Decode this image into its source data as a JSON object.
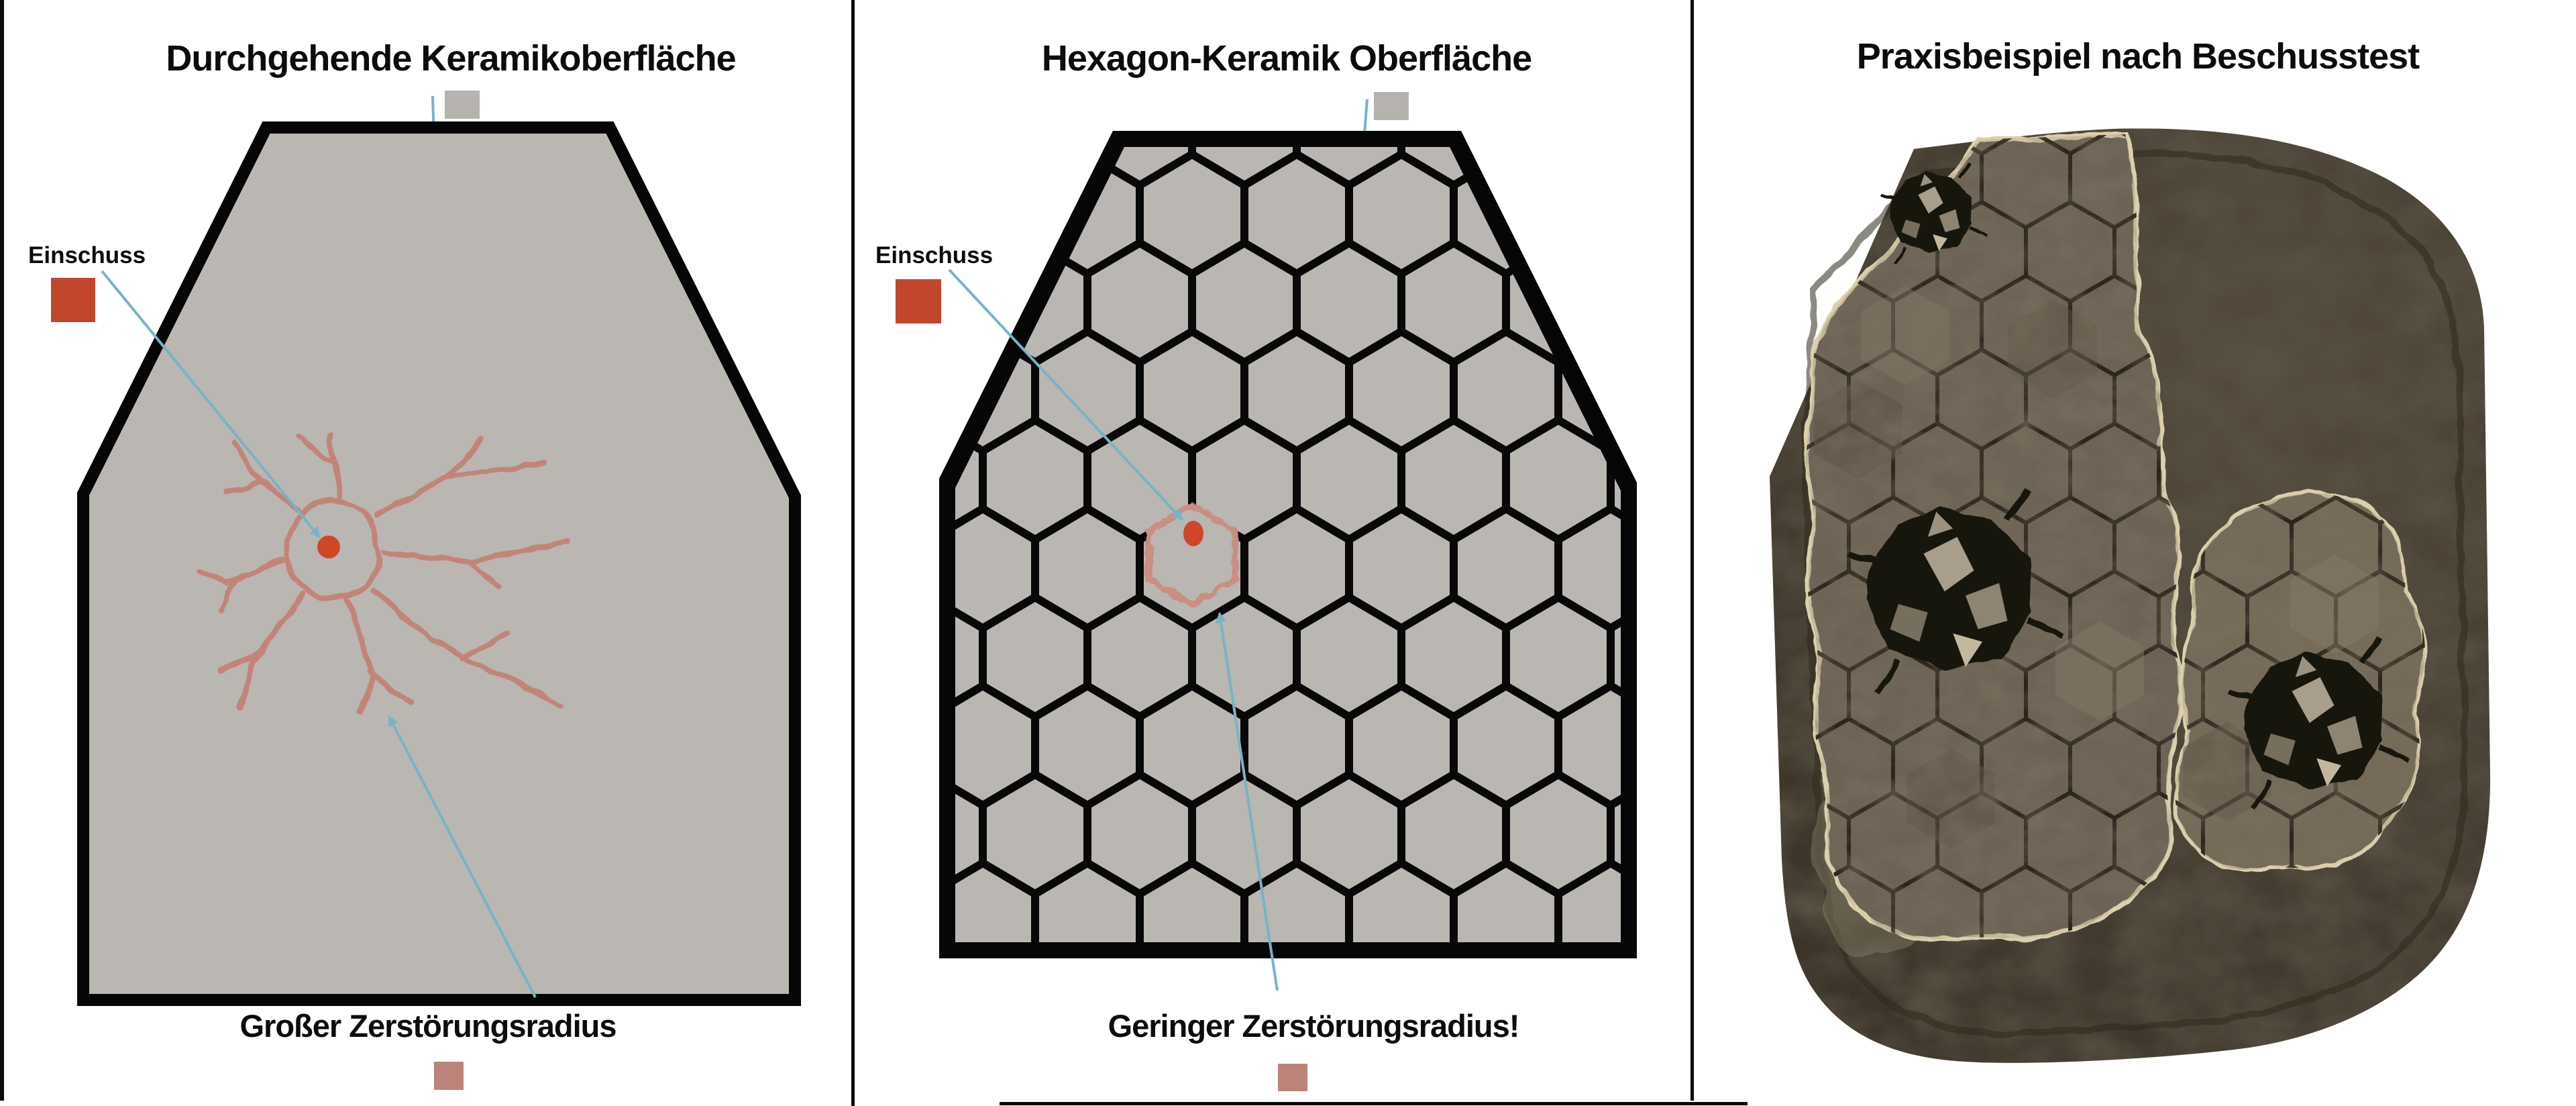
{
  "document": {
    "type": "comparison-infographic",
    "language": "de",
    "topic": "Keramik-Ballistikschutz"
  },
  "panels": {
    "continuous": {
      "title": "Durchgehende Keramikoberfläche",
      "impact_label": "Einschuss",
      "result_label": "Großer Zerstörungsradius",
      "surface_swatch_color": "#b6b2ae",
      "impact_swatch_color": "#c0472e",
      "radius_swatch_color": "#bc8379"
    },
    "hexagon": {
      "title": "Hexagon-Keramik Oberfläche",
      "impact_label": "Einschuss",
      "result_label": "Geringer Zerstörungsradius!",
      "surface_swatch_color": "#b6b2ae",
      "impact_swatch_color": "#c0472e",
      "radius_swatch_color": "#bc8379"
    },
    "photo": {
      "title": "Praxisbeispiel nach Beschusstest"
    }
  },
  "colors": {
    "background": "#ffffff",
    "outline_black": "#060606",
    "ceramic_gray": "#bab6b2",
    "annotation_teal": "#76b4c6",
    "impact_red": "#d04628",
    "crack_salmon": "#c28479",
    "photo_plate_brown": "#473f33",
    "photo_tile_tan": "#6d6455",
    "photo_torn_edge_cream": "#dccfad"
  },
  "icons": {
    "arrows": "teal annotation arrows pointing at surface, impact point and destruction radius"
  }
}
